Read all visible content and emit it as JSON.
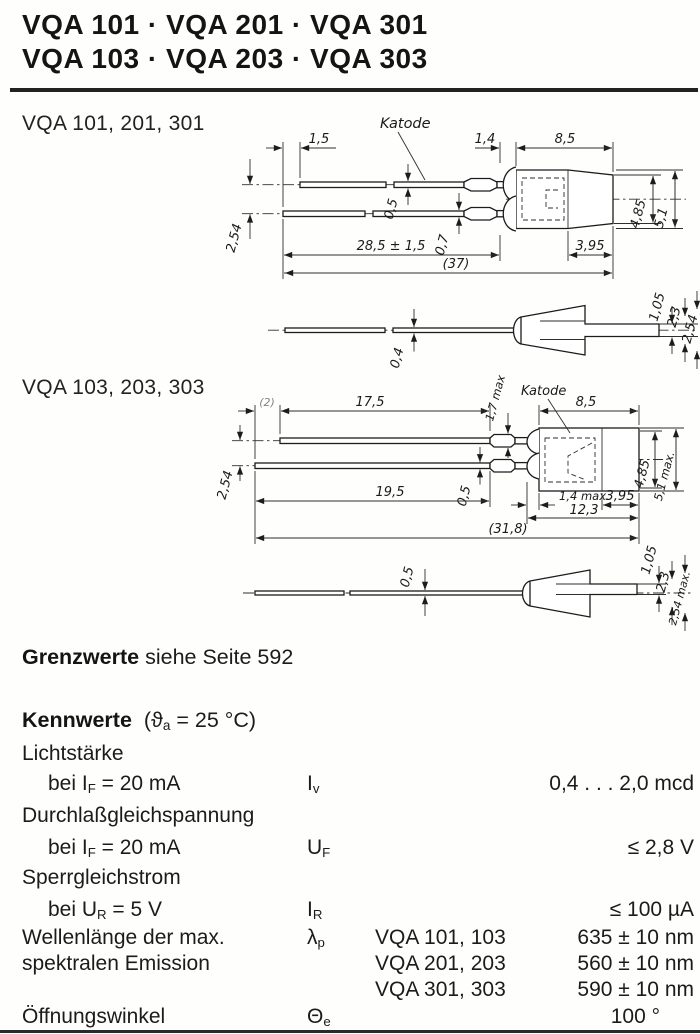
{
  "colors": {
    "ink": "#1b1b1b",
    "paper": "#fefefd"
  },
  "header": {
    "title_line1": "VQA 101 · VQA 201 · VQA 301",
    "title_line2": "VQA 103 · VQA 203 · VQA 303"
  },
  "fig1": {
    "label": "VQA 101, 201, 301",
    "katode": "Katode",
    "dims": {
      "k15": "1,5",
      "k14": "1,4",
      "k85": "8,5",
      "k05": "0,5",
      "k07": "0,7",
      "k285": "28,5 ± 1,5",
      "k37": "(37)",
      "k254": "2,54",
      "k485": "4,85",
      "k51": "5,1",
      "k395": "3,95",
      "k04": "0,4",
      "k105": "1,05",
      "k23": "2,3",
      "k254b": "2,54"
    }
  },
  "fig2": {
    "label": "VQA 103, 203, 303",
    "katode": "Katode",
    "dims": {
      "k2": "(2)",
      "k175": "17,5",
      "k17max": "1,7 max",
      "k85": "8,5",
      "k254": "2,54",
      "k05": "0,5",
      "k195": "19,5",
      "k14max": "1,4 max.",
      "k395": "3,95",
      "k123": "12,3",
      "k318": "(31,8)",
      "k485": "4,85",
      "k51max": "5,1 max.",
      "k05b": "0,5",
      "k105": "1,05",
      "k23": "2,3",
      "k254max": "2,54 max."
    }
  },
  "grenzwerte": {
    "lead": "Grenzwerte",
    "rest": " siehe Seite 592"
  },
  "kennwerte": {
    "title": "Kennwerte",
    "cond_pre": "(ϑ",
    "cond_sub": "a",
    "cond_post": " = 25 °C)",
    "lichtstaerke": {
      "group": "Lichtstärke",
      "cond_pre": "bei I",
      "cond_sub": "F",
      "cond_post": " = 20 mA",
      "sym": "I",
      "sym_sub": "v",
      "value": "0,4 . . . 2,0 mcd"
    },
    "durchlass": {
      "group": "Durchlaßgleichspannung",
      "cond_pre": "bei I",
      "cond_sub": "F",
      "cond_post": " = 20 mA",
      "sym": "U",
      "sym_sub": "F",
      "value": "≤ 2,8 V"
    },
    "sperr": {
      "group": "Sperrgleichstrom",
      "cond_pre": "bei U",
      "cond_sub": "R",
      "cond_post": " = 5 V",
      "sym": "I",
      "sym_sub": "R",
      "value": "≤ 100 µA"
    },
    "wellenlaenge": {
      "label1": "Wellenlänge der max.",
      "label2": "spektralen Emission",
      "sym": "λ",
      "sym_sub": "p",
      "rows": [
        {
          "type": "VQA 101, 103",
          "value": "635 ± 10 nm"
        },
        {
          "type": "VQA 201, 203",
          "value": "560 ± 10 nm"
        },
        {
          "type": "VQA 301, 303",
          "value": "590 ± 10 nm"
        }
      ]
    },
    "oeffnung": {
      "label": "Öffnungswinkel",
      "sym": "Θ",
      "sym_sub": "e",
      "value": "100 °"
    }
  }
}
